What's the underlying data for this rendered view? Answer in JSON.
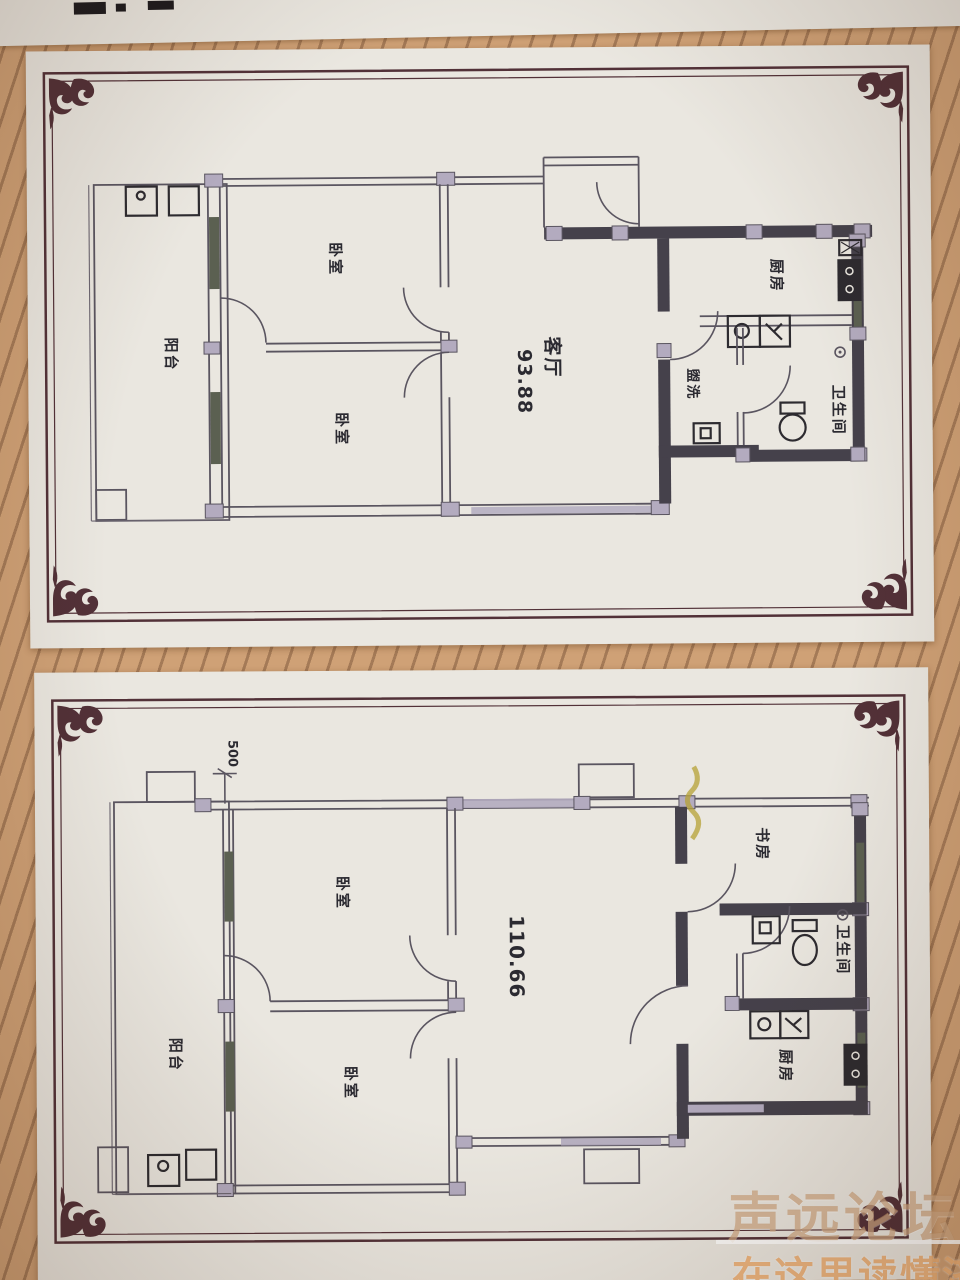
{
  "plan1": {
    "balcony": "阳台",
    "bedroom_top": "卧室",
    "bedroom_bottom": "卧室",
    "living": "客厅",
    "living_area": "93.88",
    "kitchen": "厨房",
    "washroom": "盥洗",
    "bathroom": "卫生间"
  },
  "plan2": {
    "dimension": "500",
    "balcony": "阳台",
    "bedroom_top": "卧室",
    "bedroom_bottom": "卧室",
    "living_area": "110.66",
    "study": "书房",
    "bathroom": "卫生间",
    "kitchen": "厨房"
  },
  "watermark": {
    "forum_name": "声远论坛",
    "tagline": "在这里读懂济宁"
  },
  "colors": {
    "stripe_base": "#cfa176",
    "stripe_line": "#a47a57",
    "paper": "#eae7e0",
    "frame": "#523138",
    "wall": "#45414b",
    "window_post": "#b3abbf",
    "window_glass": "#5b6051",
    "highlight_mark": "#b5a235",
    "watermark_name": "rgba(198,152,108,0.62)",
    "watermark_tagline": "rgba(235,168,104,0.82)"
  }
}
